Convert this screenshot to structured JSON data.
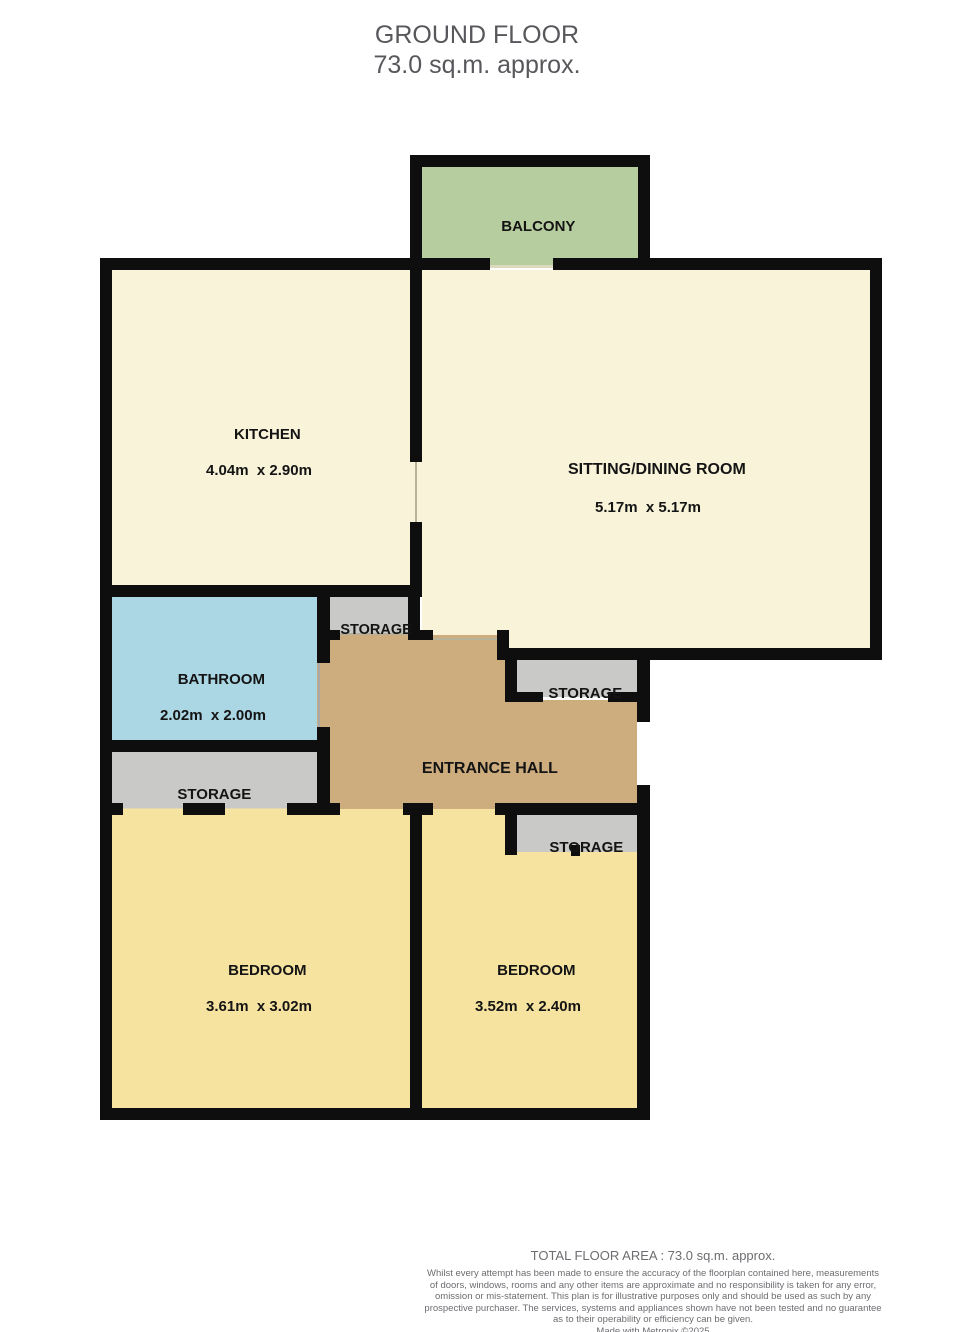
{
  "title": {
    "floor": "GROUND FLOOR",
    "area": "73.0 sq.m. approx."
  },
  "labels": {
    "storage": "STORAGE"
  },
  "rooms": {
    "balcony": {
      "name": "BALCONY"
    },
    "kitchen": {
      "name": "KITCHEN",
      "dims": "4.04m  x 2.90m"
    },
    "sitting_dining": {
      "name": "SITTING/DINING ROOM",
      "dims": "5.17m  x 5.17m"
    },
    "bathroom": {
      "name": "BATHROOM",
      "dims": "2.02m  x 2.00m"
    },
    "entrance_hall": {
      "name": "ENTRANCE HALL"
    },
    "bedroom1": {
      "name": "BEDROOM",
      "dims": "3.61m  x 3.02m"
    },
    "bedroom2": {
      "name": "BEDROOM",
      "dims": "3.52m  x 2.40m"
    }
  },
  "footer": {
    "total_area": "TOTAL FLOOR AREA : 73.0 sq.m. approx.",
    "disclaimer": "Whilst every attempt has been made to ensure the accuracy of the floorplan contained here, measurements\nof doors, windows, rooms and any other items are approximate and no responsibility is taken for any error,\nomission or mis-statement. This plan is for illustrative purposes only and should be used as such by any\nprospective purchaser. The services, systems and appliances shown have not been tested and no guarantee\nas to their operability or efficiency can be given.",
    "credit": "Made with Metropix ©2025"
  },
  "colors": {
    "wall": "#0e0e0e",
    "room_cream": "#f8f3d9",
    "balcony_green": "#b6cd9f",
    "bathroom_blue": "#abd6e3",
    "hall_tan": "#cdac7e",
    "bedroom_yellow": "#f6e3a0",
    "storage_gray": "#c9c9c7",
    "title_text": "#58585c",
    "footer_text": "#6d6d72",
    "label_text": "#141414"
  }
}
